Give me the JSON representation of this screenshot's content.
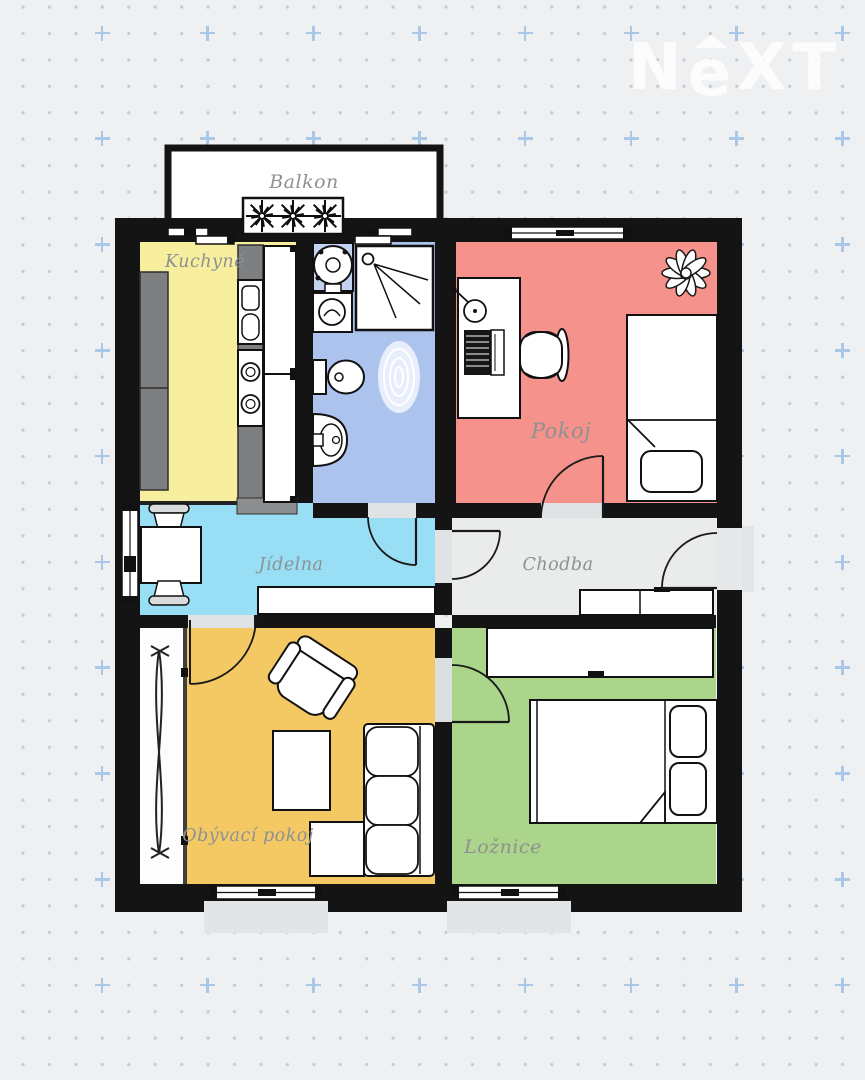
{
  "page": {
    "background_color": "#eef0f2",
    "dot_color": "#c7ccd1",
    "cross_color": "#a9c7e7"
  },
  "logo": {
    "n": "N",
    "e": "e",
    "xt": "XT",
    "color": "#ffffff"
  },
  "floorplan": {
    "wall_color": "#141414",
    "label_color": "#8d9194",
    "rooms": {
      "balkon": {
        "label": "Balkon",
        "color": "#ffffff"
      },
      "kuchyne": {
        "label": "Kuchyně",
        "color": "#f7ef9e"
      },
      "koupelna": {
        "label": "",
        "color": "#acc3ee"
      },
      "pokoj": {
        "label": "Pokoj",
        "color": "#f5928b"
      },
      "jidelna": {
        "label": "Jídelna",
        "color": "#98dff5"
      },
      "chodba": {
        "label": "Chodba",
        "color": "#eaebeb"
      },
      "obyvaci_pokoj": {
        "label": "Obývací pokoj",
        "color": "#f4c964"
      },
      "loznice": {
        "label": "Ložnice",
        "color": "#abd58a"
      }
    }
  }
}
